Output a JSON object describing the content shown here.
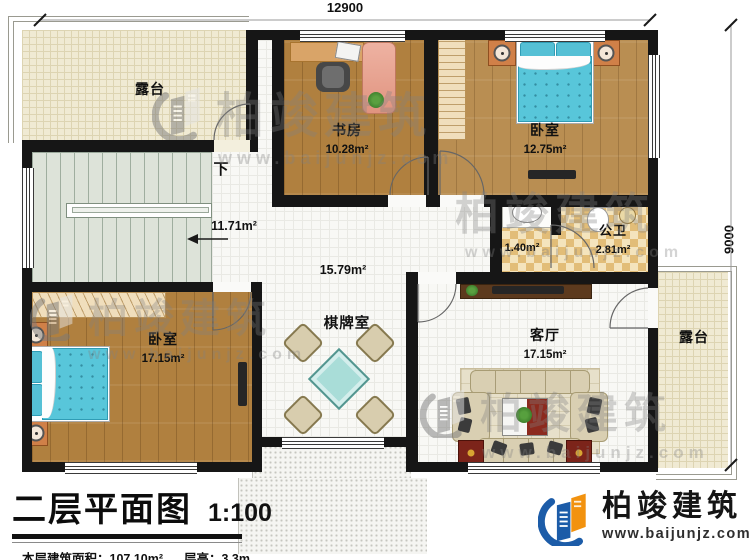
{
  "plan": {
    "dimensions": {
      "width": "12900",
      "height": "9000"
    },
    "rooms": {
      "terrace_top": {
        "name": "露台"
      },
      "terrace_right": {
        "name": "露台"
      },
      "stairs": {
        "direction": "下",
        "area": "11.71m²"
      },
      "hallway": {
        "area": "15.79m²"
      },
      "study": {
        "name": "书房",
        "area": "10.28m²"
      },
      "bedroom_top": {
        "name": "卧室",
        "area": "12.75m²"
      },
      "bathroom": {
        "name": "公卫",
        "area": "2.81m²",
        "vanity_area": "1.40m²"
      },
      "bedroom_bottom": {
        "name": "卧室",
        "area": "17.15m²"
      },
      "chess_room": {
        "name": "棋牌室"
      },
      "living_room": {
        "name": "客厅",
        "area": "17.15m²"
      }
    }
  },
  "title_block": {
    "title": "二层平面图",
    "scale": "1:100",
    "floor_area": "本层建筑面积：107.10m²",
    "floor_height": "层高：3.3m"
  },
  "branding": {
    "company": "柏竣建筑",
    "website": "www.baijunjz.com"
  },
  "colors": {
    "wall": "#161616",
    "wood_floor": "#b0803f",
    "terrace_floor": "#f0ead3",
    "bath_tile": "#e2bd78",
    "bed": "#58c6da",
    "logo_blue": "#1c5ca8",
    "logo_orange": "#f2920f"
  }
}
